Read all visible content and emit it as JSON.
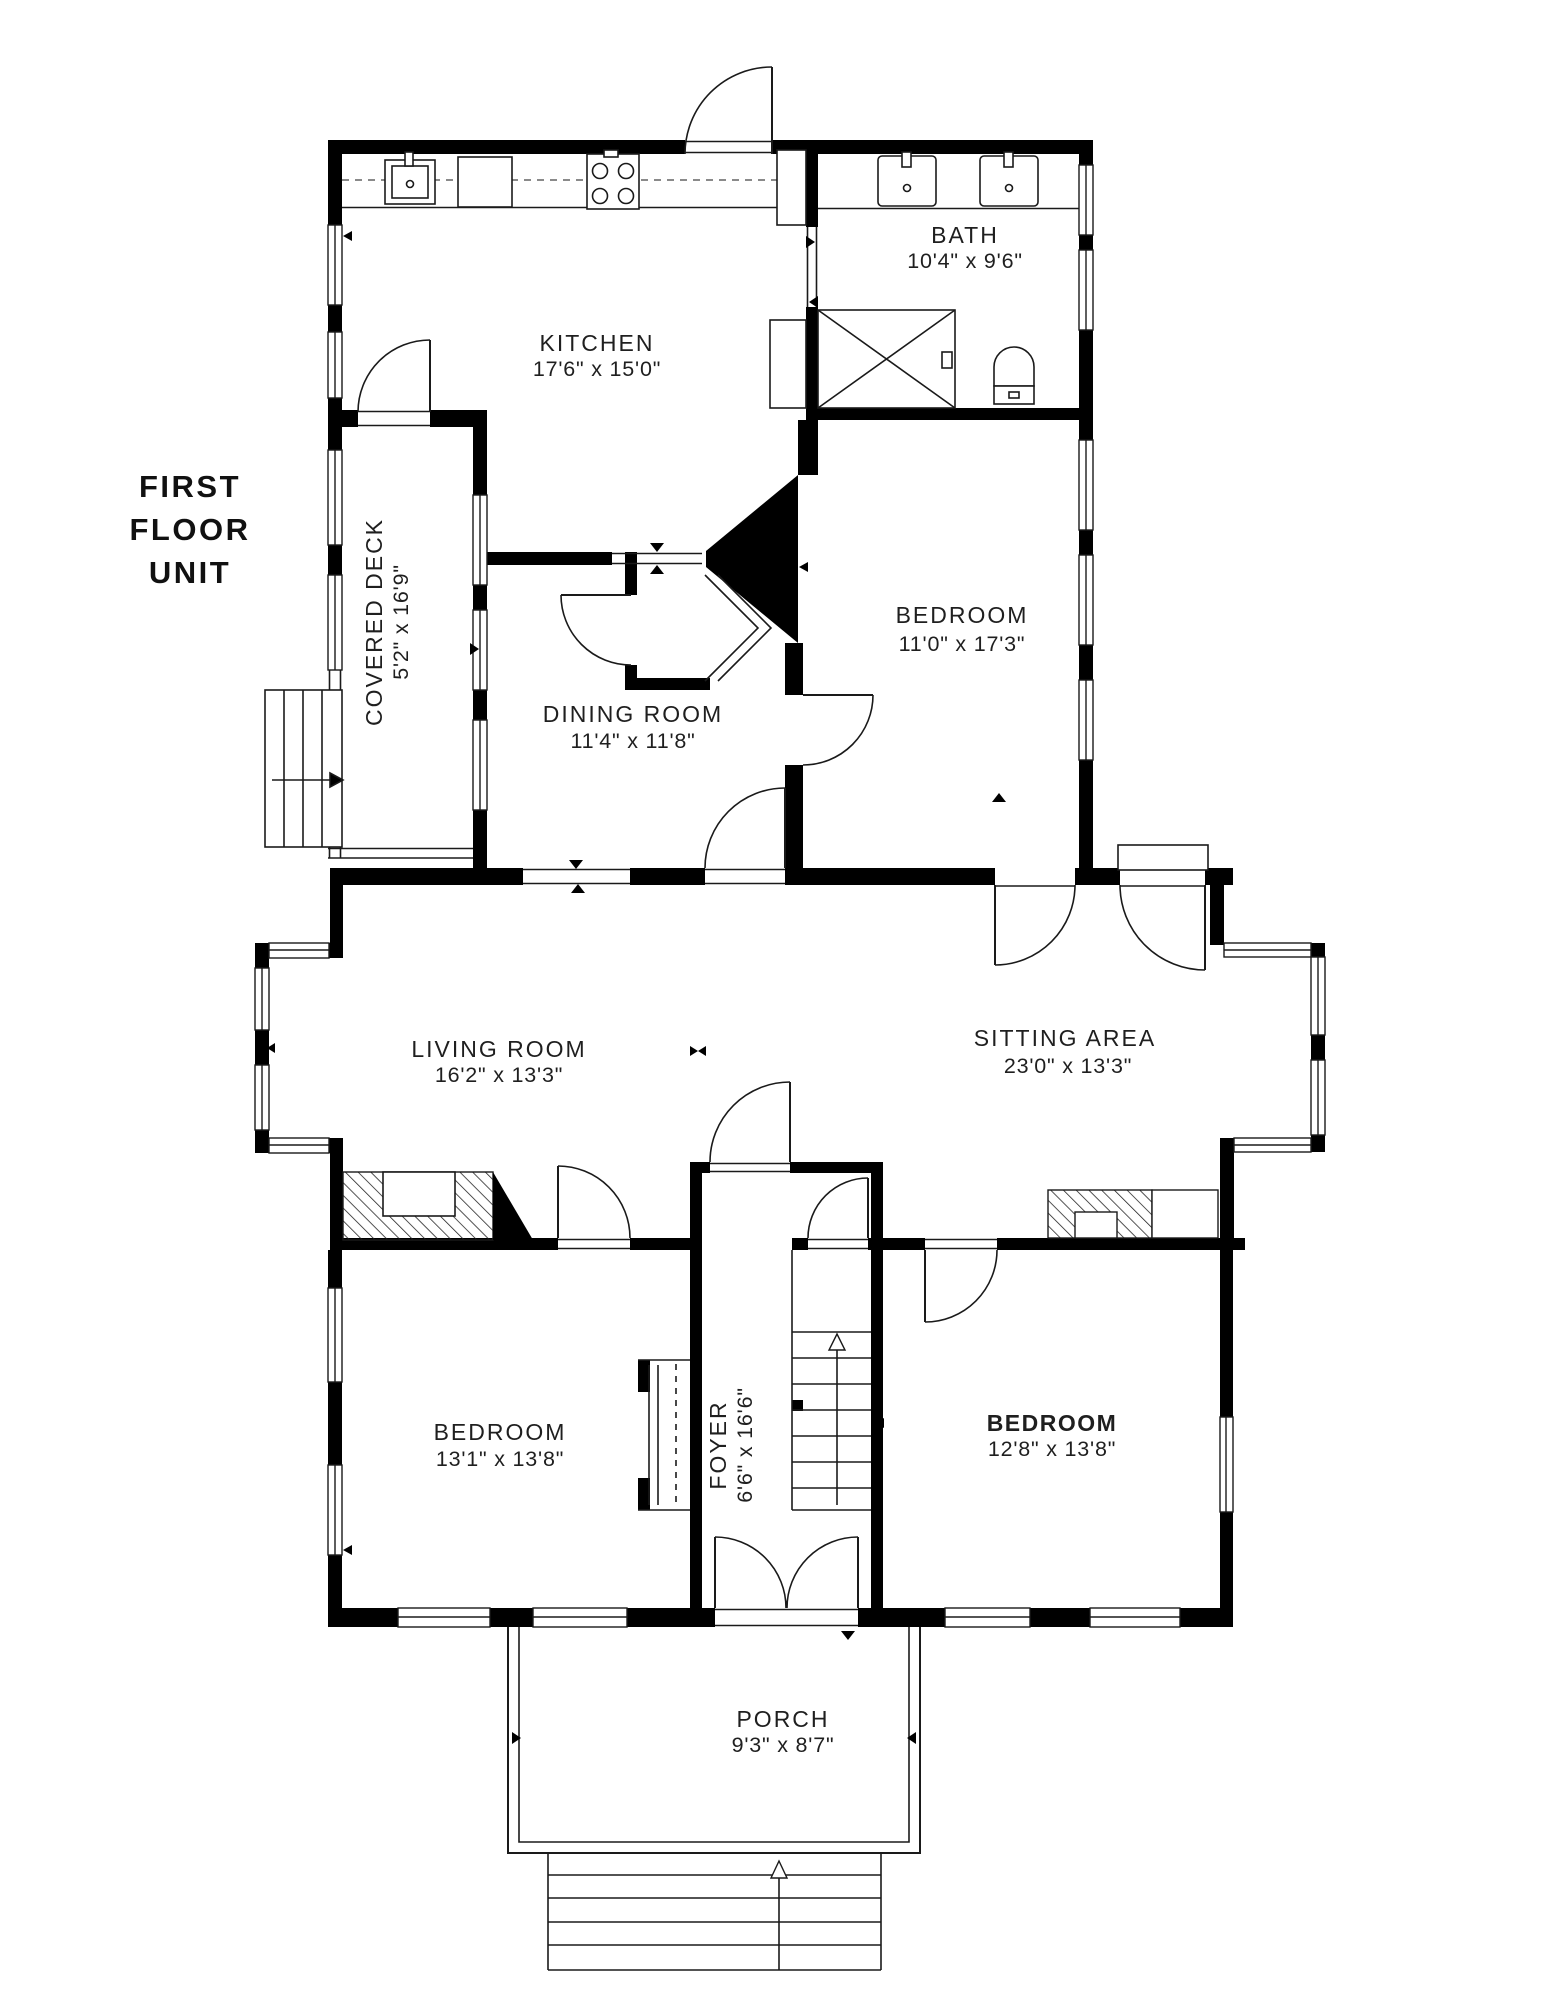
{
  "title": {
    "lines": [
      "FIRST",
      "FLOOR",
      "UNIT"
    ]
  },
  "rooms": [
    {
      "name": "KITCHEN",
      "dims": "17'6\" x 15'0\""
    },
    {
      "name": "BATH",
      "dims": "10'4\" x 9'6\""
    },
    {
      "name": "BEDROOM",
      "dims": "11'0\" x 17'3\""
    },
    {
      "name": "DINING ROOM",
      "dims": "11'4\" x 11'8\""
    },
    {
      "name": "COVERED DECK",
      "dims": "5'2\" x 16'9\""
    },
    {
      "name": "LIVING ROOM",
      "dims": "16'2\" x 13'3\""
    },
    {
      "name": "SITTING AREA",
      "dims": "23'0\" x 13'3\""
    },
    {
      "name": "BEDROOM",
      "dims": "13'1\" x 13'8\""
    },
    {
      "name": "FOYER",
      "dims": "6'6\" x 16'6\""
    },
    {
      "name": "BEDROOM",
      "dims": "12'8\" x 13'8\""
    },
    {
      "name": "PORCH",
      "dims": "9'3\" x 8'7\""
    }
  ],
  "colors": {
    "wall": "#000000",
    "line": "#1a1a1a",
    "text": "#1f1f1f",
    "background": "#ffffff"
  },
  "fixtures": [
    "stove",
    "kitchen-sink",
    "dishwasher",
    "refrigerator-cabinet",
    "bath-vanity-sinks",
    "shower",
    "toilet",
    "chimney",
    "living-room-fireplace",
    "sitting-area-fireplace",
    "bedroom-closet",
    "upper-bedroom-closet",
    "main-staircase",
    "deck-stairs",
    "porch-steps",
    "entry-double-door",
    "rear-landing"
  ]
}
